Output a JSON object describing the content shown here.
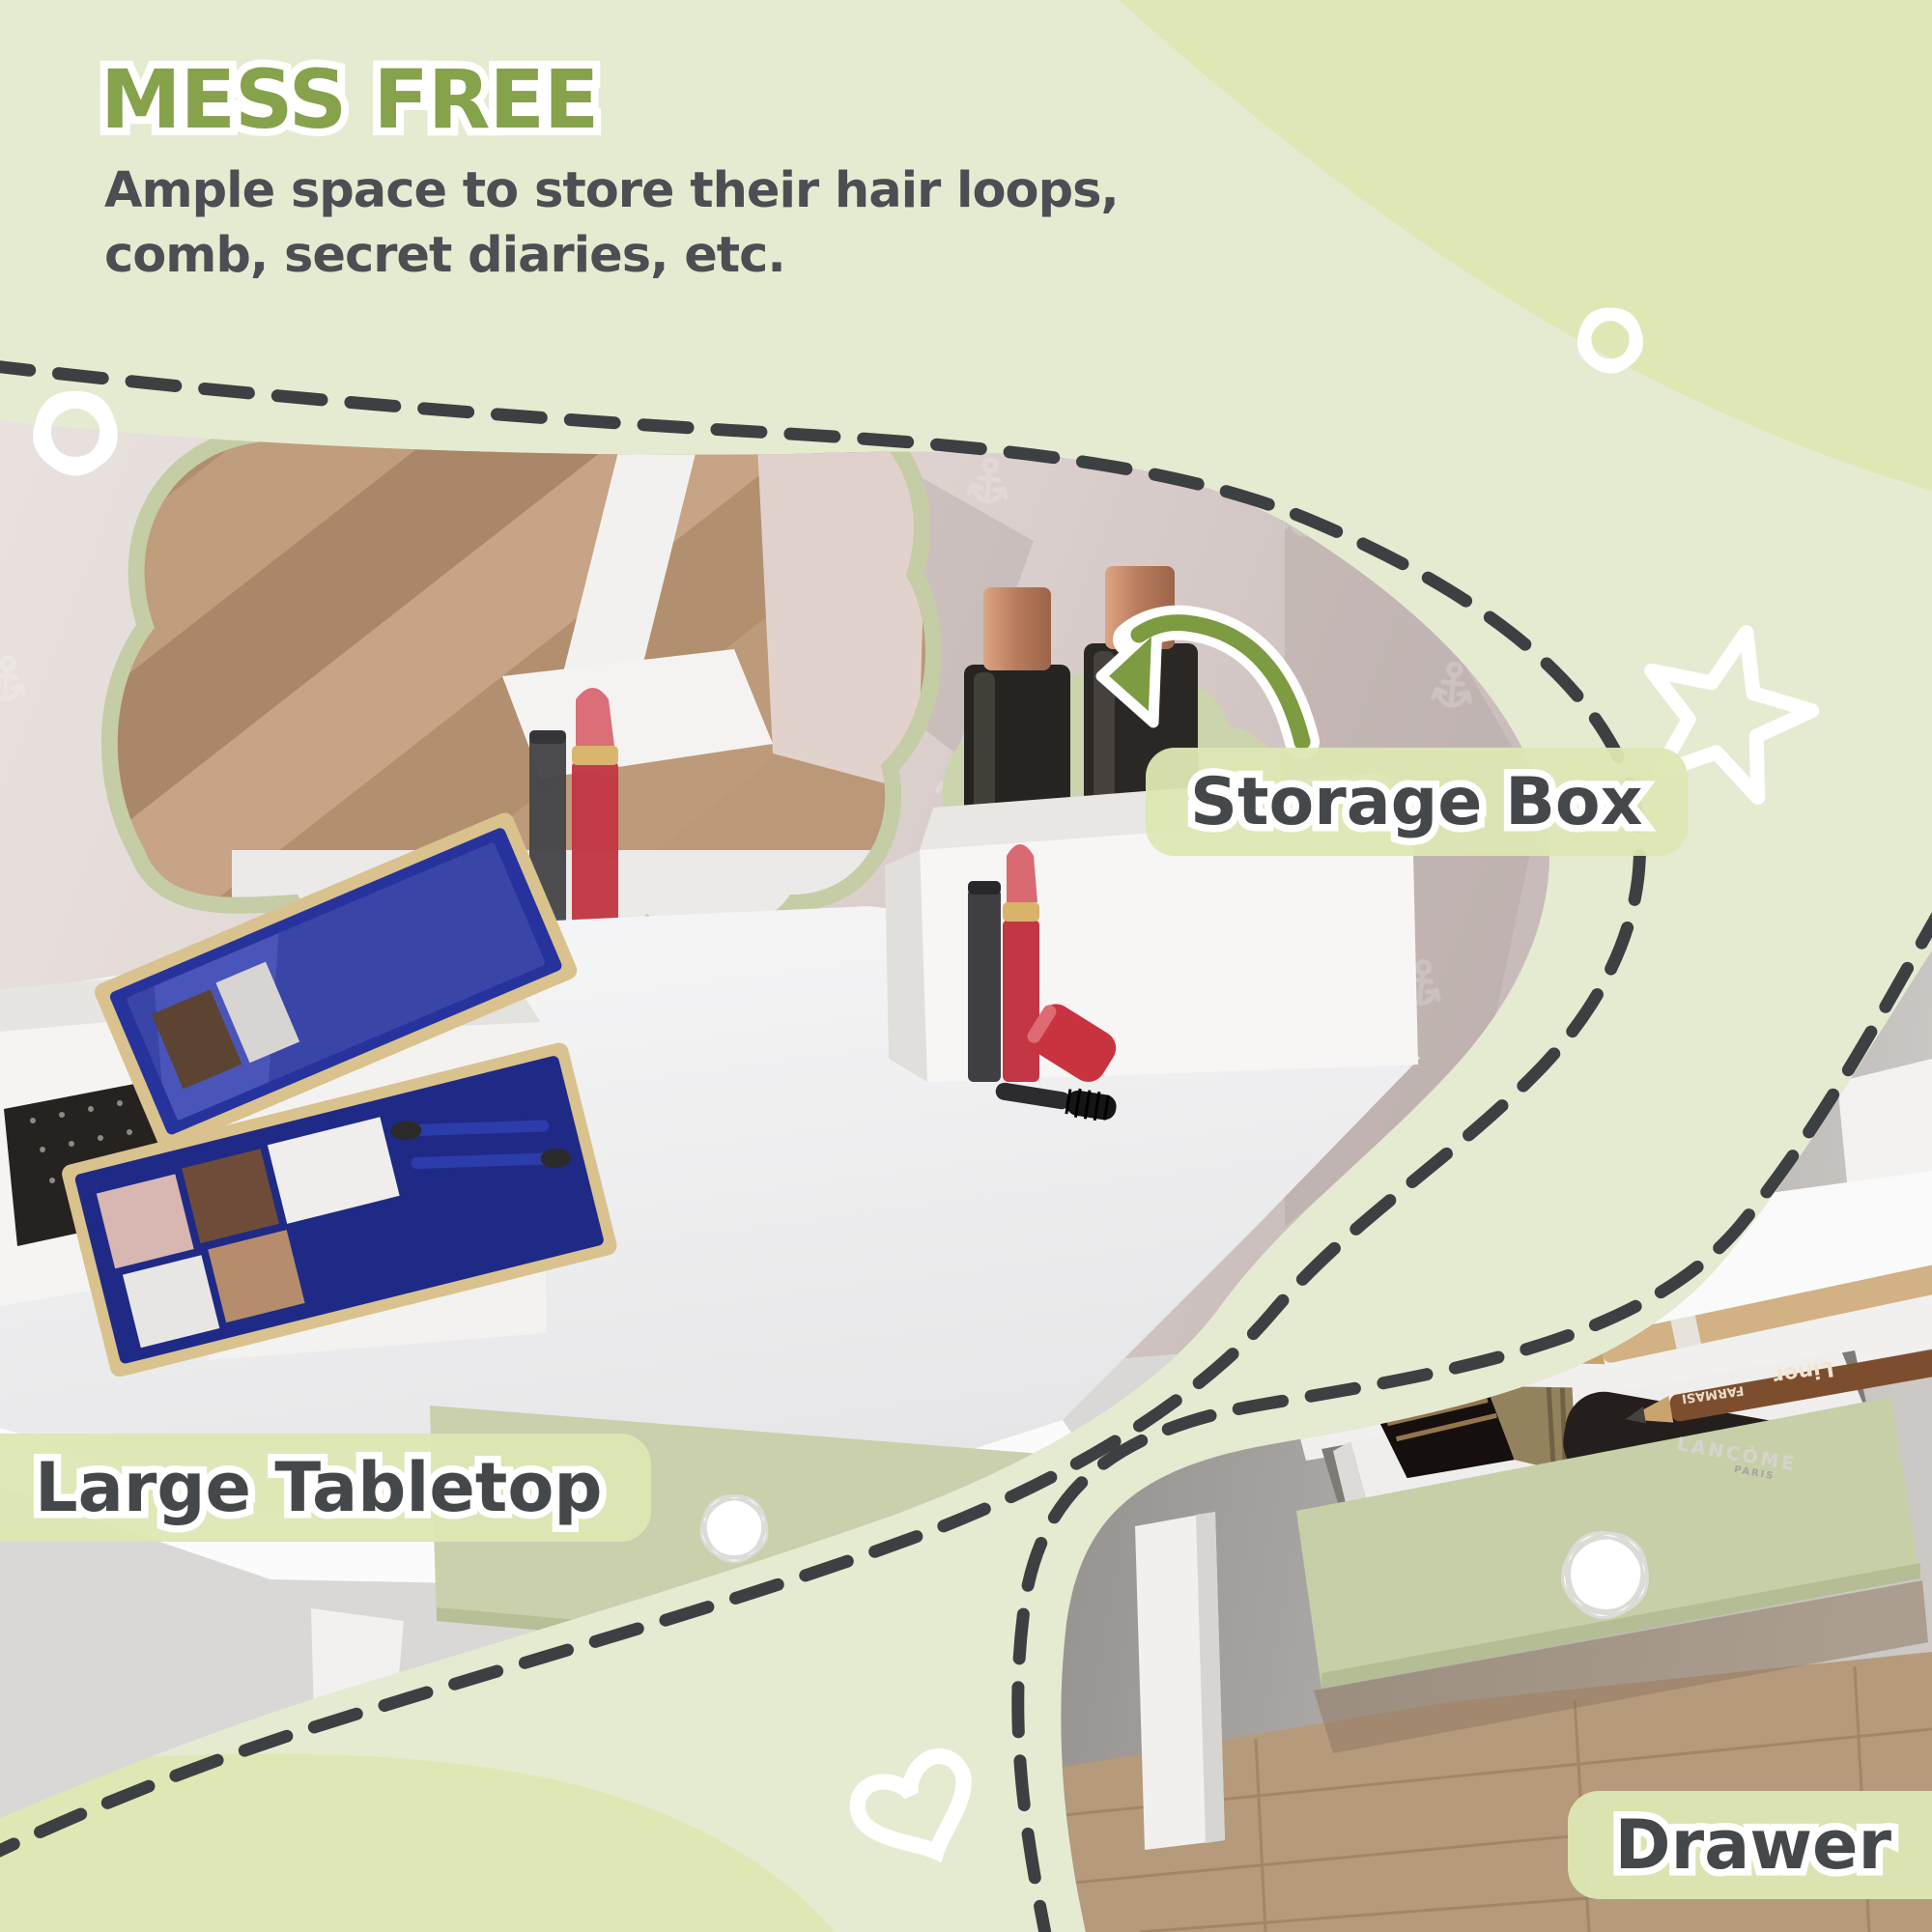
{
  "page": {
    "background_color": "#e5ebd1",
    "accent_blob_color": "#dfe7b4",
    "dash_color": "#3c4043",
    "white_outline_color": "#ffffff"
  },
  "header": {
    "title": "MESS FREE",
    "title_color": "#86a24b",
    "description_line1": "Ample space to store their hair loops,",
    "description_line2": "comb, secret diaries, etc.",
    "description_color": "#4b4e52"
  },
  "callouts": {
    "pill_color": "#dde7b3",
    "label_text_color": "#45484b",
    "arrow_color": "#7d9b41",
    "storage_box": {
      "label": "Storage Box"
    },
    "large_tabletop": {
      "label": "Large Tabletop"
    },
    "drawer": {
      "label": "Drawer"
    }
  },
  "photo_products": {
    "brush_brand": "LANCÔME",
    "brush_subtext": "PARIS",
    "pencil_text": "Liner",
    "pencil_brand": "FARMASI"
  },
  "decor": {
    "shapes": [
      "flower-icon-left",
      "flower-icon-top-right",
      "star-icon",
      "heart-icon"
    ],
    "outline_color": "#ffffff"
  }
}
